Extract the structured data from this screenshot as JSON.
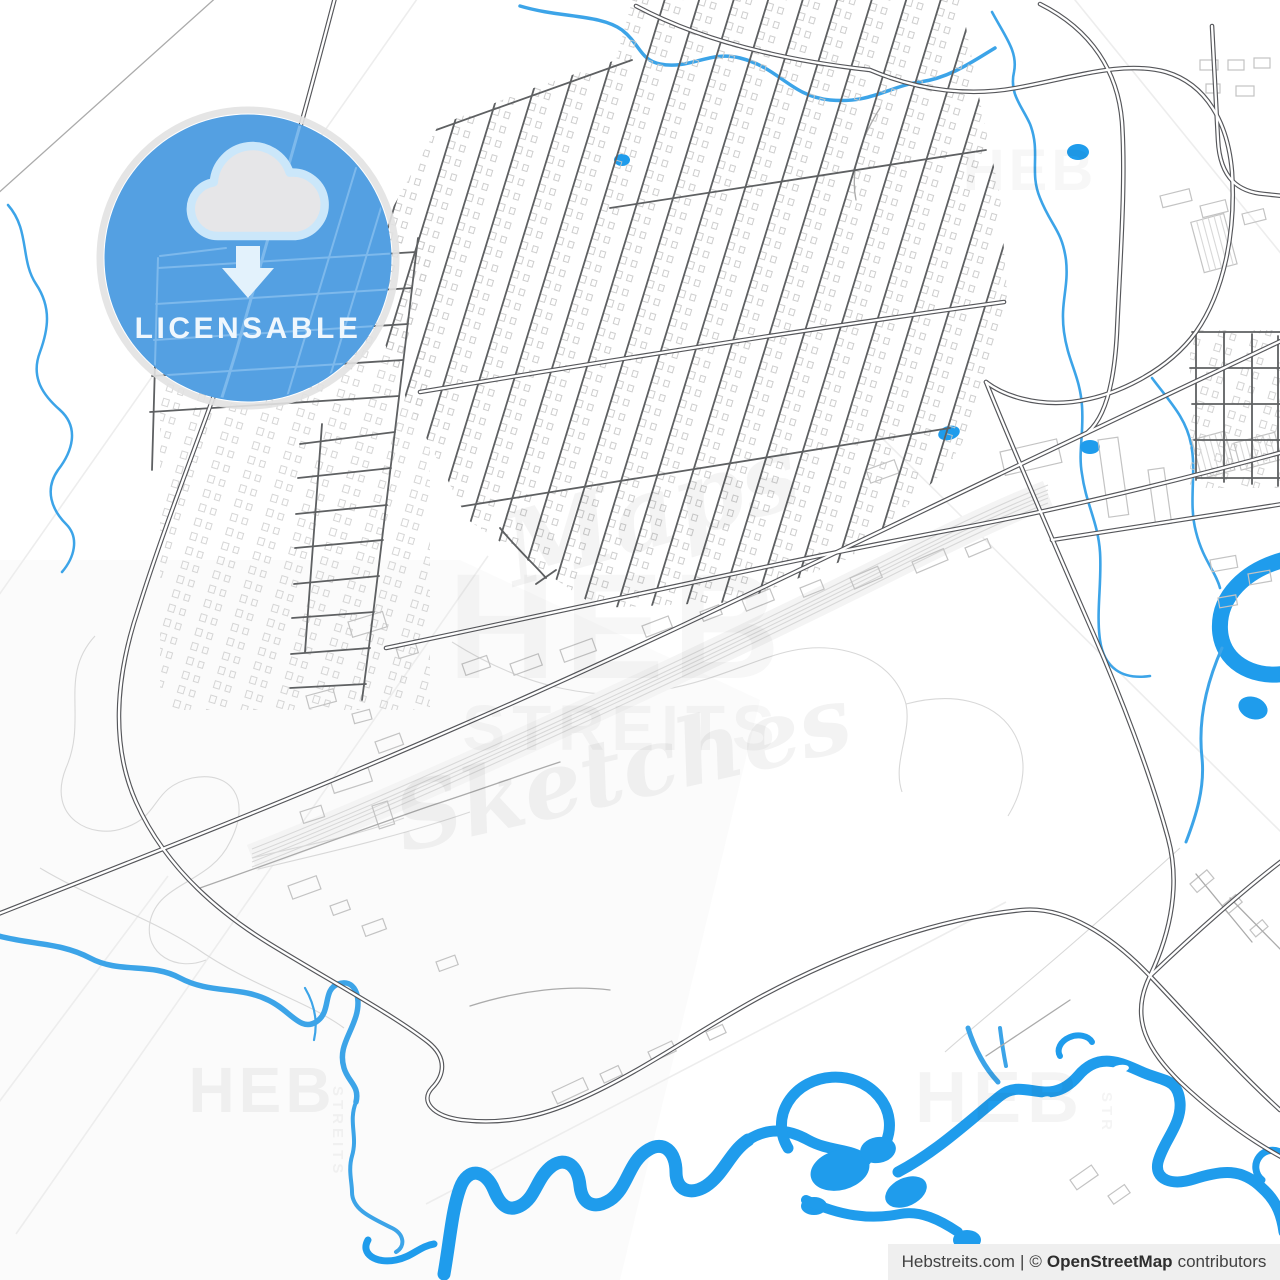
{
  "badge": {
    "label": "LICENSABLE",
    "icon": "cloud-download-icon",
    "circle_color": "#54A0E2",
    "ring_color": "#E2E2E2",
    "cloud_fill": "#E6E6E8",
    "cloud_outline": "#CBE7FA",
    "arrow_color": "#E3F2FC",
    "text_color": "#EFF7FD"
  },
  "watermarks": {
    "maps_script": "Maps",
    "heb": "HEB",
    "streits": "STREITS",
    "sketches_script": "Sketches",
    "heb_bottom_left": "HEB",
    "heb_bottom_right": "HEB",
    "heb_top_right": "HEB",
    "streits_vertical": "STREITS",
    "str_vertical": "STR"
  },
  "attribution": {
    "site": "Hebstreits.com",
    "separator": "|",
    "copyright": "©",
    "source": "OpenStreetMap",
    "suffix": "contributors"
  },
  "map": {
    "colors": {
      "background": "#FFFFFF",
      "water": "#1F9CEC",
      "stream": "#3CA4E8",
      "road_major": "#55565A",
      "road_minor": "#ABABAB",
      "building": "#C3C3C3",
      "texture": "#EDEDED"
    }
  }
}
